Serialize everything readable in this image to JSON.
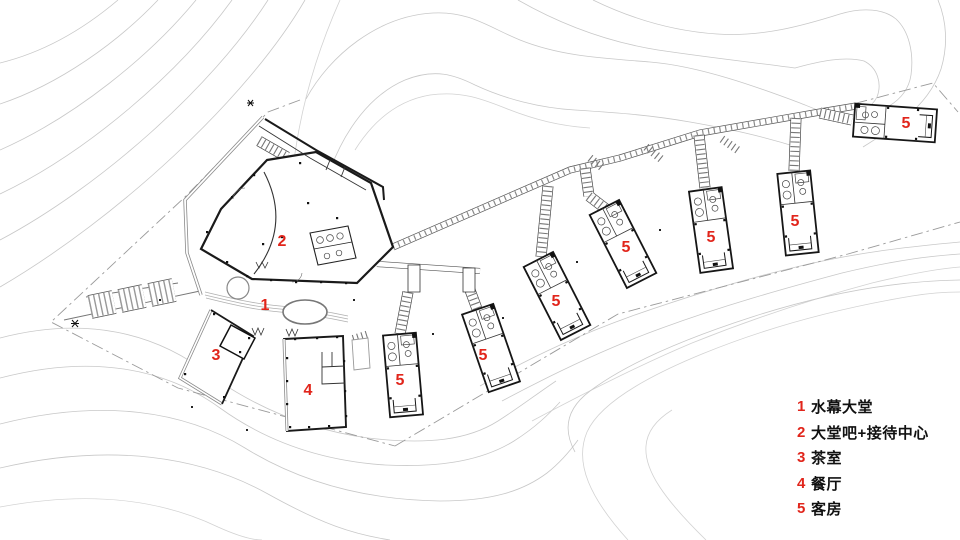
{
  "plan": {
    "title": "resort-site-plan",
    "markers": [
      {
        "id": "water-lobby",
        "label": "1"
      },
      {
        "id": "lobby-bar",
        "label": "2"
      },
      {
        "id": "tea-room",
        "label": "3"
      },
      {
        "id": "restaurant",
        "label": "4"
      },
      {
        "id": "guestroom-a",
        "label": "5"
      },
      {
        "id": "guestroom-b",
        "label": "5"
      },
      {
        "id": "guestroom-c",
        "label": "5"
      },
      {
        "id": "guestroom-d",
        "label": "5"
      },
      {
        "id": "guestroom-e",
        "label": "5"
      },
      {
        "id": "guestroom-f",
        "label": "5"
      },
      {
        "id": "guestroom-g",
        "label": "5"
      }
    ]
  },
  "legend": {
    "items": [
      {
        "num": "1",
        "label": "水幕大堂"
      },
      {
        "num": "2",
        "label": "大堂吧+接待中心"
      },
      {
        "num": "3",
        "label": "茶室"
      },
      {
        "num": "4",
        "label": "餐厅"
      },
      {
        "num": "5",
        "label": "客房"
      }
    ]
  },
  "colors": {
    "marker_red": "#e1251b",
    "wall_black": "#1a1a1a",
    "contour_gray": "#c8c8c8",
    "boundary_gray": "#9a9a9a"
  }
}
